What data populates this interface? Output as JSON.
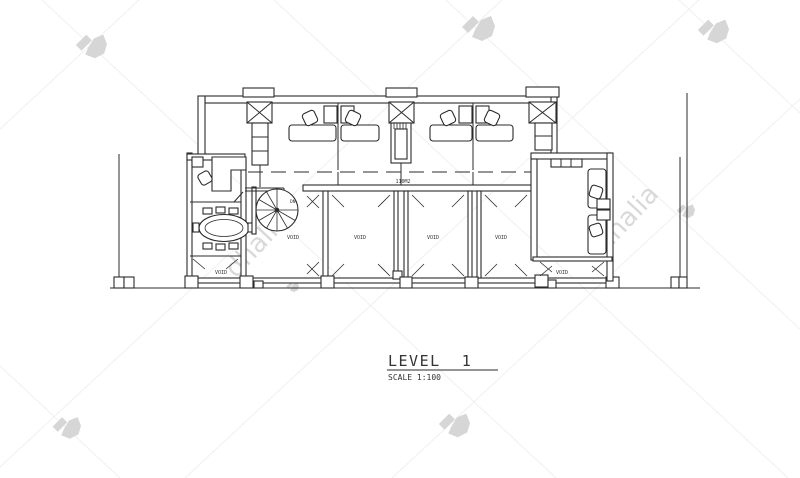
{
  "title_block": {
    "title": "LEVEL  1",
    "scale": "SCALE 1:100"
  },
  "plan": {
    "area_label": "110M2",
    "stair_label": "DN",
    "voids": {
      "left": "VOID",
      "stair": "VOID",
      "bay3": "VOID",
      "bay4": "VOID",
      "bay5": "VOID",
      "right": "VOID"
    }
  },
  "watermark": {
    "brand": "dhalia",
    "text_color": "#d9d9d9",
    "gem_color": "#d6d6d6",
    "lattice_color": "#f0f0f0"
  },
  "colors": {
    "ink": "#2b2b2b",
    "background": "#ffffff"
  }
}
